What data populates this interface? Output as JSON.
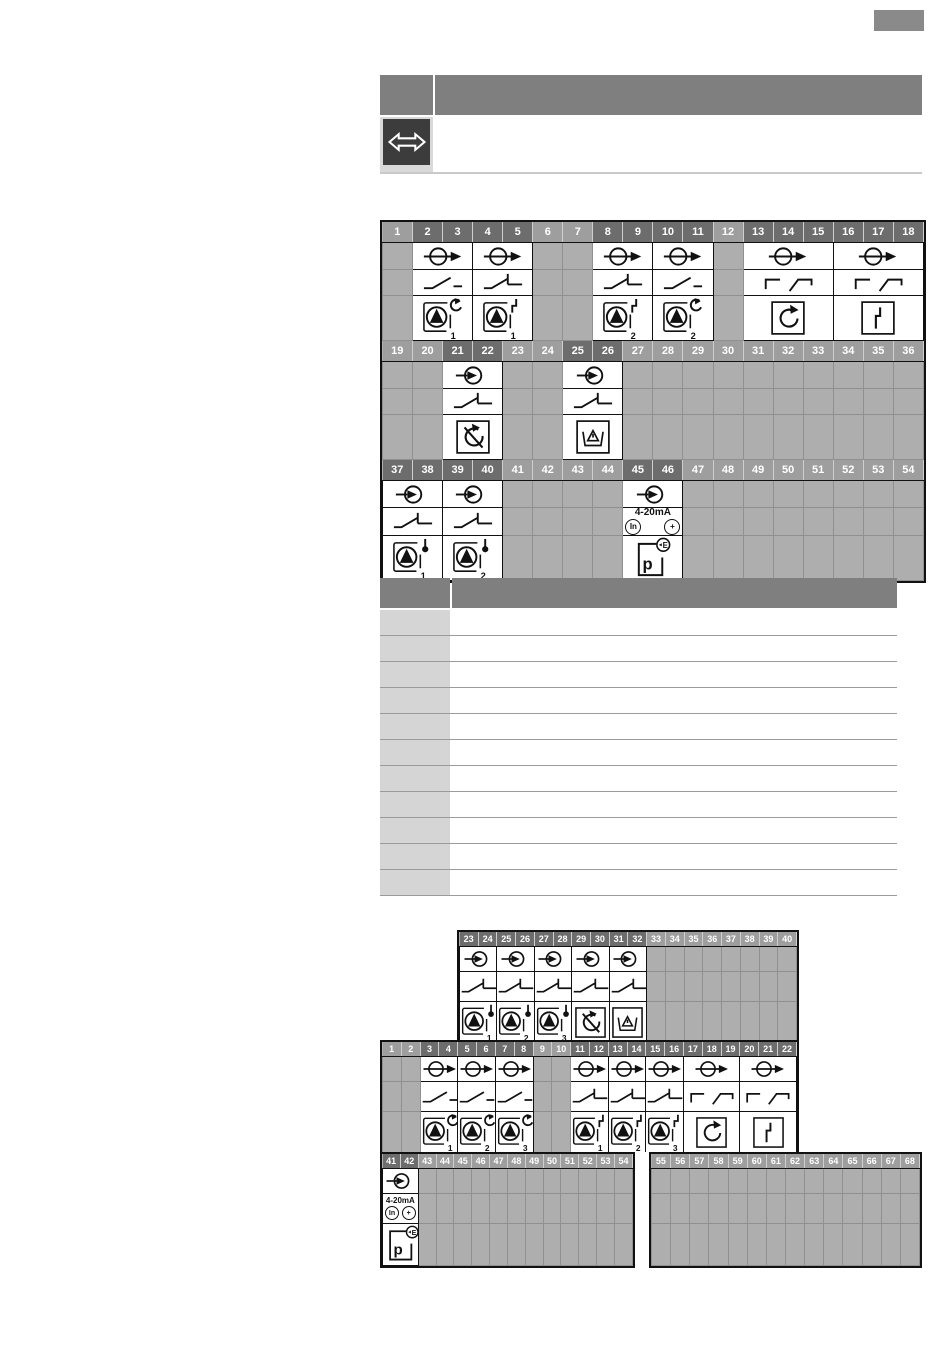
{
  "colors": {
    "header_used": "#6d6d6d",
    "header_unused": "#9e9e9e",
    "cell_unused": "#aeaeae",
    "panel_gray": "#7f7f7f",
    "row_label_gray": "#d5d5d5",
    "icon_tile_dark": "#3c3c3c",
    "badge_gray": "#8a8a8a"
  },
  "badge": {
    "text": ""
  },
  "info_table": {
    "header_left": "",
    "header_right": "",
    "row_icon": "bidirectional-arrow-icon",
    "row_text": ""
  },
  "labels": {
    "analog_range": "4-20mA",
    "analog_in": "In",
    "analog_plus": "+",
    "pressure_p": "p",
    "pressure_e": "E"
  },
  "diagram_main": {
    "blocks": [
      {
        "items": [
          {
            "type": "unused",
            "nums": [
              1
            ]
          },
          {
            "type": "group",
            "nums": [
              2,
              3
            ],
            "rows": [
              "relay-output",
              "contact-no",
              "pump-run"
            ],
            "sub": "1"
          },
          {
            "type": "group",
            "nums": [
              4,
              5
            ],
            "rows": [
              "relay-output",
              "contact-no-limit",
              "pump-fault"
            ],
            "sub": "1"
          },
          {
            "type": "unused",
            "nums": [
              6,
              7
            ]
          },
          {
            "type": "group",
            "nums": [
              8,
              9
            ],
            "rows": [
              "relay-output",
              "contact-no-limit",
              "pump-fault"
            ],
            "sub": "2"
          },
          {
            "type": "group",
            "nums": [
              10,
              11
            ],
            "rows": [
              "relay-output",
              "contact-no",
              "pump-run"
            ],
            "sub": "2"
          },
          {
            "type": "unused",
            "nums": [
              12
            ]
          },
          {
            "type": "group",
            "nums": [
              13,
              14,
              15
            ],
            "rows": [
              "relay-output",
              "contact-changeover",
              "rotation"
            ]
          },
          {
            "type": "group",
            "nums": [
              16,
              17,
              18
            ],
            "rows": [
              "relay-output",
              "contact-changeover",
              "fault"
            ]
          }
        ]
      },
      {
        "items": [
          {
            "type": "unused",
            "nums": [
              19,
              20
            ]
          },
          {
            "type": "group",
            "nums": [
              21,
              22
            ],
            "rows": [
              "signal-input",
              "contact-no-limit",
              "no-rotation"
            ]
          },
          {
            "type": "unused",
            "nums": [
              23,
              24
            ]
          },
          {
            "type": "group",
            "nums": [
              25,
              26
            ],
            "rows": [
              "signal-input",
              "contact-no-limit",
              "leak-basin"
            ]
          },
          {
            "type": "unused",
            "nums": [
              27,
              28,
              29,
              30,
              31,
              32,
              33,
              34,
              35,
              36
            ]
          }
        ]
      },
      {
        "items": [
          {
            "type": "group",
            "nums": [
              37,
              38
            ],
            "rows": [
              "signal-input",
              "contact-no-limit",
              "pump-temp"
            ],
            "sub": "1"
          },
          {
            "type": "group",
            "nums": [
              39,
              40
            ],
            "rows": [
              "signal-input",
              "contact-no-limit",
              "pump-temp"
            ],
            "sub": "2"
          },
          {
            "type": "unused",
            "nums": [
              41,
              42,
              43,
              44
            ]
          },
          {
            "type": "group",
            "nums": [
              45,
              46
            ],
            "rows": [
              "signal-input",
              "analog-4-20ma",
              "pressure-sensor"
            ]
          },
          {
            "type": "unused",
            "nums": [
              47,
              48,
              49,
              50,
              51,
              52,
              53,
              54
            ]
          }
        ]
      }
    ]
  },
  "legend_table": {
    "header_left": "",
    "header_right": "",
    "rows": [
      {
        "term": "",
        "desc": ""
      },
      {
        "term": "",
        "desc": ""
      },
      {
        "term": "",
        "desc": ""
      },
      {
        "term": "",
        "desc": ""
      },
      {
        "term": "",
        "desc": ""
      },
      {
        "term": "",
        "desc": ""
      },
      {
        "term": "",
        "desc": ""
      },
      {
        "term": "",
        "desc": ""
      },
      {
        "term": "",
        "desc": ""
      },
      {
        "term": "",
        "desc": ""
      },
      {
        "term": "",
        "desc": ""
      }
    ]
  },
  "diagram_secondary": {
    "strip_upper": {
      "items": [
        {
          "type": "group",
          "nums": [
            23,
            24
          ],
          "rows": [
            "signal-input",
            "contact-no-limit",
            "pump-temp"
          ],
          "sub": "1"
        },
        {
          "type": "group",
          "nums": [
            25,
            26
          ],
          "rows": [
            "signal-input",
            "contact-no-limit",
            "pump-temp"
          ],
          "sub": "2"
        },
        {
          "type": "group",
          "nums": [
            27,
            28
          ],
          "rows": [
            "signal-input",
            "contact-no-limit",
            "pump-temp"
          ],
          "sub": "3"
        },
        {
          "type": "group",
          "nums": [
            29,
            30
          ],
          "rows": [
            "signal-input",
            "contact-no-limit",
            "no-rotation"
          ]
        },
        {
          "type": "group",
          "nums": [
            31,
            32
          ],
          "rows": [
            "signal-input",
            "contact-no-limit",
            "leak-basin"
          ]
        },
        {
          "type": "unused",
          "nums": [
            33,
            34,
            35,
            36,
            37,
            38,
            39,
            40
          ]
        }
      ]
    },
    "strip_middle": {
      "items": [
        {
          "type": "unused",
          "nums": [
            1,
            2
          ]
        },
        {
          "type": "group",
          "nums": [
            3,
            4
          ],
          "rows": [
            "relay-output",
            "contact-no",
            "pump-run"
          ],
          "sub": "1"
        },
        {
          "type": "group",
          "nums": [
            5,
            6
          ],
          "rows": [
            "relay-output",
            "contact-no",
            "pump-run"
          ],
          "sub": "2"
        },
        {
          "type": "group",
          "nums": [
            7,
            8
          ],
          "rows": [
            "relay-output",
            "contact-no",
            "pump-run"
          ],
          "sub": "3"
        },
        {
          "type": "unused",
          "nums": [
            9,
            10
          ]
        },
        {
          "type": "group",
          "nums": [
            11,
            12
          ],
          "rows": [
            "relay-output",
            "contact-no-limit",
            "pump-fault"
          ],
          "sub": "1"
        },
        {
          "type": "group",
          "nums": [
            13,
            14
          ],
          "rows": [
            "relay-output",
            "contact-no-limit",
            "pump-fault"
          ],
          "sub": "2"
        },
        {
          "type": "group",
          "nums": [
            15,
            16
          ],
          "rows": [
            "relay-output",
            "contact-no-limit",
            "pump-fault"
          ],
          "sub": "3"
        },
        {
          "type": "group",
          "nums": [
            17,
            18,
            19
          ],
          "rows": [
            "relay-output",
            "contact-changeover",
            "rotation"
          ]
        },
        {
          "type": "group",
          "nums": [
            20,
            21,
            22
          ],
          "rows": [
            "relay-output",
            "contact-changeover",
            "fault"
          ]
        }
      ]
    },
    "strip_lower_left": {
      "items": [
        {
          "type": "group",
          "nums": [
            41,
            42
          ],
          "rows": [
            "signal-input",
            "analog-4-20ma",
            "pressure-sensor"
          ]
        },
        {
          "type": "unused",
          "nums": [
            43,
            44,
            45,
            46,
            47,
            48,
            49,
            50,
            51,
            52,
            53,
            54
          ]
        }
      ]
    },
    "strip_lower_right": {
      "items": [
        {
          "type": "unused",
          "nums": [
            55,
            56,
            57,
            58,
            59,
            60,
            61,
            62,
            63,
            64,
            65,
            66,
            67,
            68
          ]
        }
      ]
    }
  }
}
